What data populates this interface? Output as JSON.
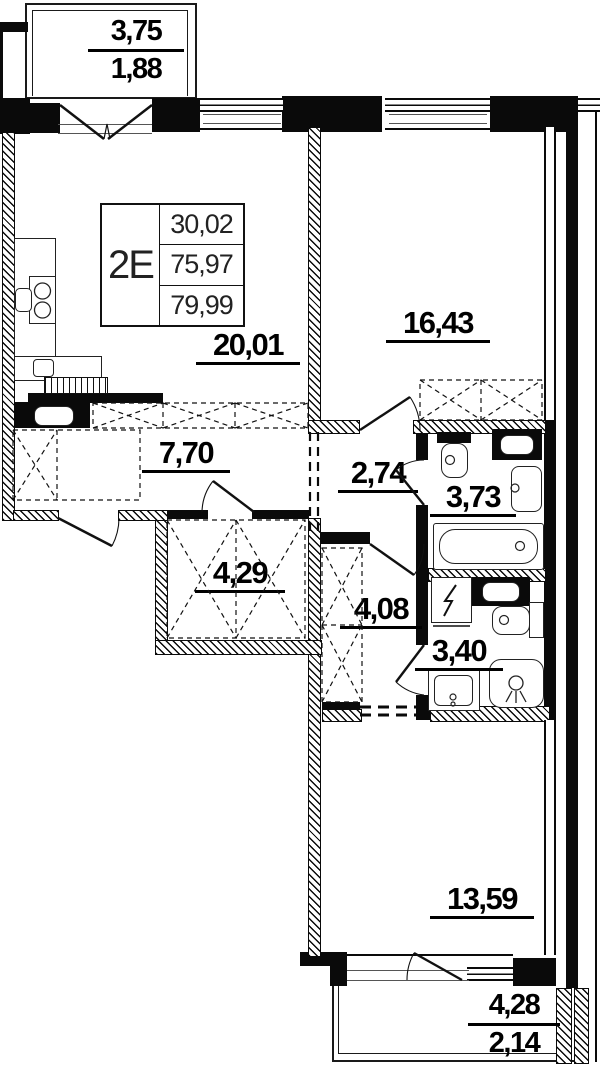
{
  "unit_card": {
    "unit_label": "2E",
    "areas": [
      "30,02",
      "75,97",
      "79,99"
    ]
  },
  "rooms": {
    "living_kitchen": {
      "area": "20,01"
    },
    "bedroom_top": {
      "area": "16,43"
    },
    "hallway": {
      "area": "7,70"
    },
    "corridor": {
      "area": "2,74"
    },
    "bathroom": {
      "area": "3,73"
    },
    "closet": {
      "area": "4,29"
    },
    "hall": {
      "area": "4,08"
    },
    "wc": {
      "area": "3,40"
    },
    "bedroom_bottom": {
      "area": "13,59"
    }
  },
  "balconies": {
    "top": {
      "full": "3,75",
      "reduced": "1,88"
    },
    "bottom": {
      "full": "4,28",
      "reduced": "2,14"
    }
  },
  "colors": {
    "wall": "#0a0a0a",
    "background": "#ffffff",
    "thin_line": "#555555"
  }
}
